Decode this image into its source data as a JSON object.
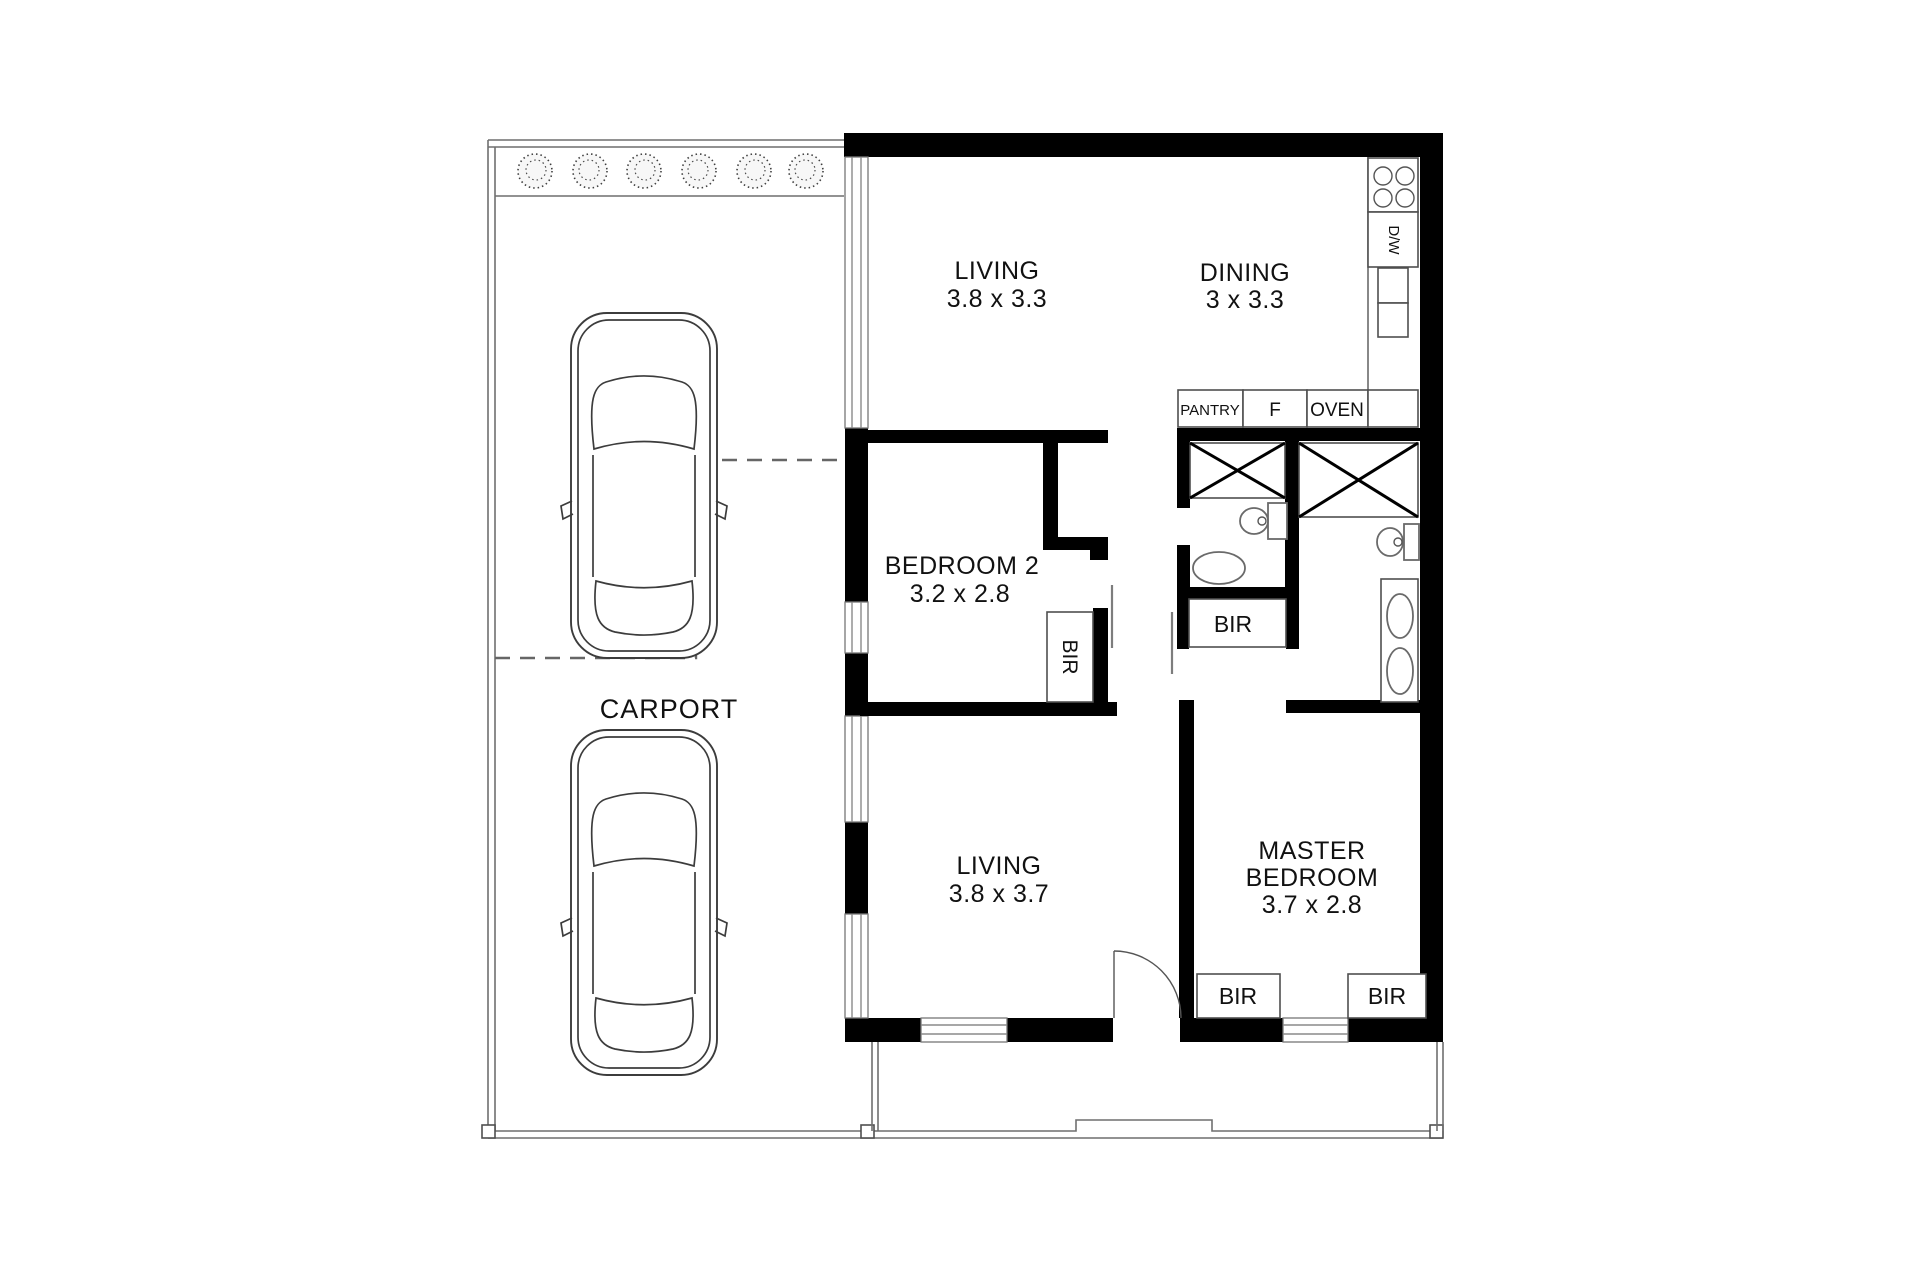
{
  "title": "Two bedroom floor plan with carport",
  "colors": {
    "wall": "#000000",
    "thin_line": "#555555",
    "glazing": "#8a8a8a",
    "text": "#111111",
    "background": "#ffffff"
  },
  "carport": {
    "label": "CARPORT"
  },
  "rooms": {
    "living_top": {
      "name": "LIVING",
      "dims": "3.8 x 3.3"
    },
    "dining": {
      "name": "DINING",
      "dims": "3 x 3.3"
    },
    "bedroom2": {
      "name": "BEDROOM 2",
      "dims": "3.2 x 2.8"
    },
    "living_bottom": {
      "name": "LIVING",
      "dims": "3.8 x 3.7"
    },
    "master": {
      "name_line1": "MASTER",
      "name_line2": "BEDROOM",
      "dims": "3.7 x 2.8"
    }
  },
  "kitchen": {
    "dishwasher": "D/W",
    "pantry": "PANTRY",
    "fridge": "F",
    "oven": "OVEN"
  },
  "robes": {
    "bedroom2_bir": "BIR",
    "hall_bir": "BIR",
    "master_bir_left": "BIR",
    "master_bir_right": "BIR"
  }
}
